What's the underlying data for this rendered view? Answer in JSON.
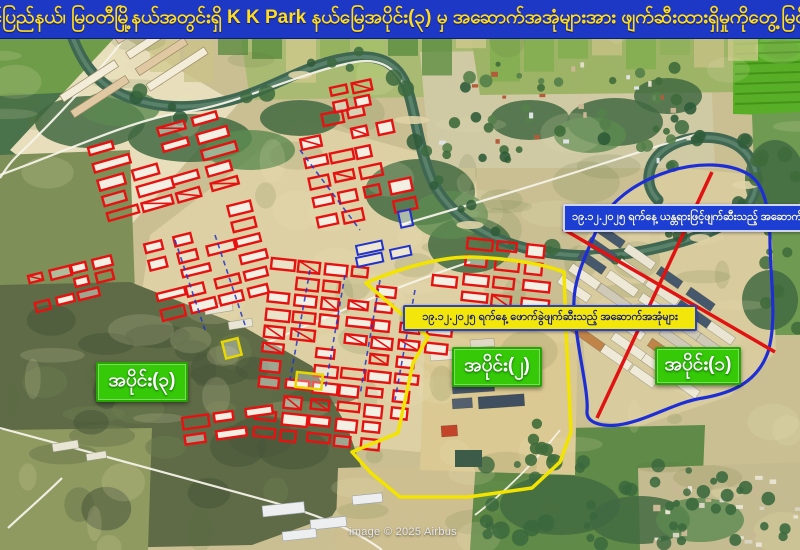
{
  "banner": {
    "text": "ကရင်ပြည်နယ်၊ မြဝတီမြို့နယ်အတွင်းရှိ  K K Park နယ်မြေအပိုင်း(၃) မှ အဆောက်အအုံများအား ဖျက်ဆီးထားရှိမှုကိုတွေ့မြင်ရစဉ်",
    "bg_color": "#1e38c6",
    "text_color": "#ffdc1e"
  },
  "map": {
    "credit": "image © 2025 Airbus",
    "labels": {
      "machine_demolition_note": {
        "text": "၁၉.၁၂.၂၀၂၅ ရက်နေ့ ယန္တရားဖြင့်ဖျက်ဆီးသည့် အဆောက်"
      },
      "explosive_demolition_note": {
        "text": "၁၉.၁၂.၂၀၂၅ ရက်နေ့ ဖောက်ခွဲဖျက်ဆီးသည့် အဆောက်အအုံများ"
      },
      "section_3": {
        "text": "အပိုင်း(၃)"
      },
      "section_2": {
        "text": "အပိုင်း(၂)"
      },
      "section_1": {
        "text": "အပိုင်း(၁)"
      }
    },
    "colors": {
      "demolished_marker": "#e61212",
      "boundary_yellow": "#f2e400",
      "boundary_blue": "#1d2ed6",
      "cross_line_red": "#e11212",
      "marker_blue": "#2233cc",
      "section_label_bg": "#35c908",
      "note_yellow_bg": "#f2e60a",
      "note_blue_bg": "#1c3ed2",
      "river": "#3f6752",
      "road": "#f5f2e8"
    }
  }
}
